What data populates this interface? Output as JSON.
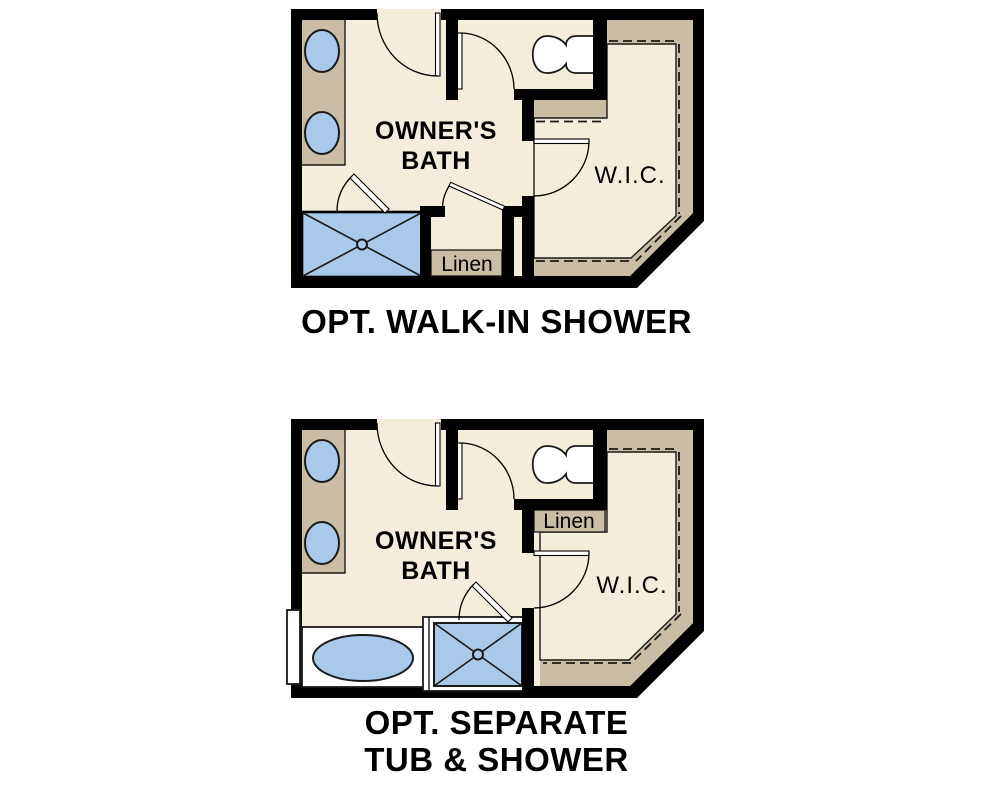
{
  "colors": {
    "background": "#ffffff",
    "wall": "#000000",
    "floor": "#f4eddc",
    "cabinet_tan": "#c9bda3",
    "fixture_blue": "#a9c9ea",
    "line": "#1a1a1a",
    "text": "#000000"
  },
  "plans": [
    {
      "room_label_line1": "OWNER'S",
      "room_label_line2": "BATH",
      "closet_label": "W.I.C.",
      "linen_label": "Linen",
      "caption": "OPT. WALK-IN SHOWER"
    },
    {
      "room_label_line1": "OWNER'S",
      "room_label_line2": "BATH",
      "closet_label": "W.I.C.",
      "linen_label": "Linen",
      "caption_line1": "OPT. SEPARATE",
      "caption_line2": "TUB & SHOWER"
    }
  ]
}
